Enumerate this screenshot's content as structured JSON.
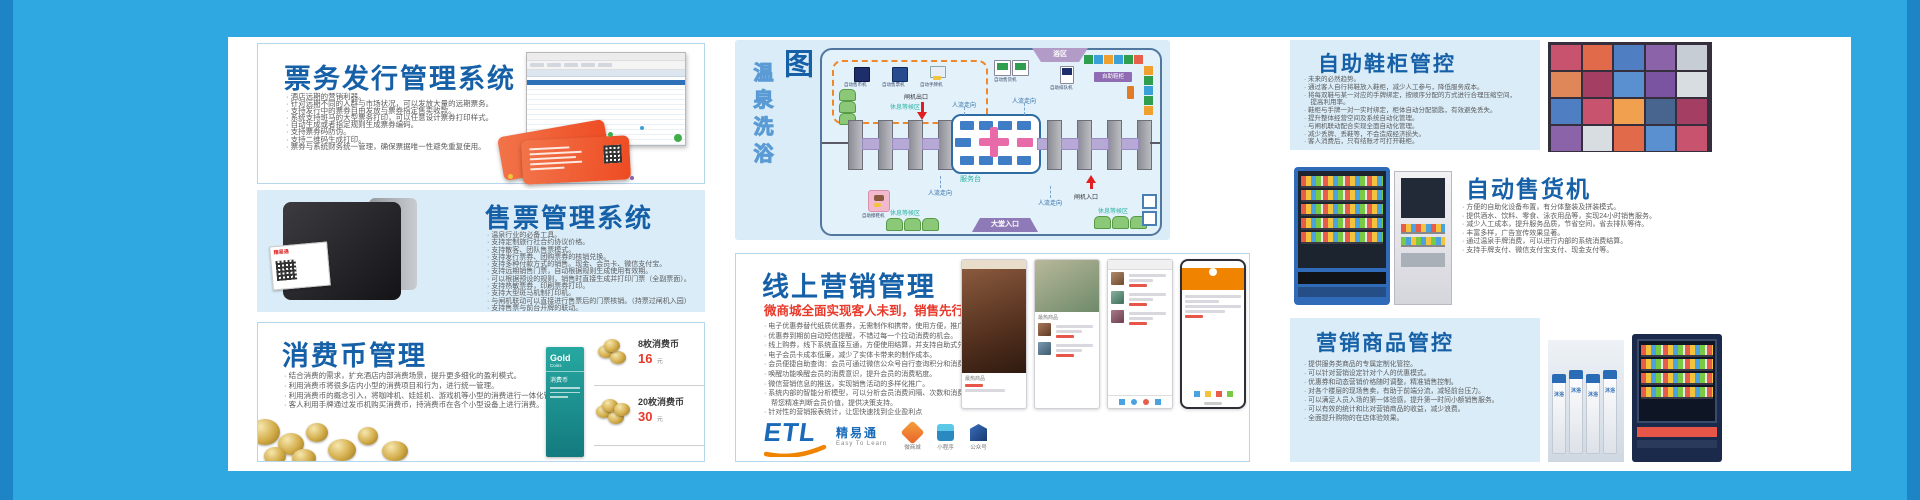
{
  "frame": {
    "outer_blue": "#2fa7e0",
    "edge_blue": "#1d84c5",
    "content_bg": "#ffffff",
    "panel_blue": "#d9ecf8",
    "title_blue": "#1660a8",
    "accent_red": "#e8392a",
    "teal": "#2bb3a3"
  },
  "panels": {
    "ticket_issue": {
      "title": "票务发行管理系统",
      "bullets": [
        "· 酒店远期的营销利器。",
        "· 针对远期不同的人群与市场状况，可以发放大量的远期票务。",
        "· 支持发行中的票券自由发放与票券指定售卖收款。",
        "· 系统支持斑马的大型票务打印，可以任意设计票券打印样式。",
        "· 自动生成或者指定规则生成票券编码。",
        "· 支持票券码防伪。",
        "· 支持二维码生成打印。",
        "· 票券与系统财务统一管理，确保票据唯一性避免重复使用。"
      ]
    },
    "ticket_sale": {
      "title": "售票管理系统",
      "bullets": [
        "· 温泉行业的必备工具。",
        "· 支持定制旅行社合约协议价格。",
        "· 支持散客、团队售票模式。",
        "· 支持发行票券、团购票券的核销兑换。",
        "· 支持多种付款方式的销售。现金、会员卡、微信支付宝。",
        "· 支持远期销售门票，自动根据规则生成使用有效期。",
        "· 可以根据预设的规则，销售时直接生成并打印门票（全副票面）。",
        "· 支持热敏票券，印刷票券打印。",
        "· 支持大型斑马机制打印机。",
        "· 与闸机联动可以直接进行售票后的门票核销。（持票过闸机入园）",
        "· 支持售票与前台开牌的联动。"
      ],
      "printer_brand": "精易通"
    },
    "coin": {
      "title": "消费币管理",
      "bullets": [
        "· 结合消费的需求，扩充酒店内部消费场景，提升更多细化的盈利模式。",
        "· 利用消费币将很多店内小型的消费项目和行为，进行统一管理。",
        "· 利用消费币的概念引入，将咖啡机、娃娃机、游戏机等小型的消费进行一体化管理结算。",
        "· 客人利用手牌通过发币机购买消费币，持消费币在各个小型设备上进行消费。"
      ],
      "card": {
        "brand": "Gold",
        "brand2": "Coins",
        "sub": "消费币"
      },
      "prices": [
        {
          "name": "8枚消费币",
          "price": "16",
          "unit": "元"
        },
        {
          "name": "20枚消费币",
          "price": "30",
          "unit": "元"
        }
      ]
    },
    "flow": {
      "title_main": "自助化流程图",
      "title_sub": "温泉洗浴",
      "labels": {
        "coin_machine": "自动售币机",
        "ticket_machine": "自动售票机",
        "band_machine": "自动手牌机",
        "rest_area": "休息等候区",
        "vending": "自动售货机",
        "bath": "浴区",
        "queue": "自助排队机",
        "shoe_locker": "自助鞋柜",
        "gate_exit": "闸机出口",
        "gate_entry": "闸机入口",
        "service_desk": "服务台",
        "lobby": "大堂入口",
        "shoe_shine": "自助擦鞋机",
        "flow_dir": "人流走向"
      },
      "locker_row": [
        "#2f9e4f",
        "#3aa0d8",
        "#f0a02f",
        "#3aa0d8",
        "#2f9e4f",
        "#e8604a"
      ],
      "locker_col": [
        "#f0a02f",
        "#2f9e4f",
        "#3aa0d8",
        "#2f9e4f",
        "#f0a02f"
      ]
    },
    "marketing": {
      "title": "线上营销管理",
      "subtitle": "微商城全面实现客人未到，销售先行的理念",
      "bullets": [
        "· 电子优惠券替代纸质优惠券，无需制作和携带，使用方便，推广迅速",
        "· 优惠券到期前自动短信提醒，不错过每一个拉动消费的机会。",
        "· 线上购券，线下系统直接互通，方便使用结算，并支持自助式兑换。",
        "· 电子会员卡成本低廉，减少了实体卡带来的制作成本。",
        "· 会员便捷自助查询：会员可通过微信公众号自行查询积分和消费记录。",
        "· 唤醒功能唤醒会员的消费意识，提升会员的消费粘度。",
        "· 微信营销信息的推送，实现销售活动的多样化推广。",
        "· 系统内部的智能分析模型，可以分析会员消费间隔、次数和消费习惯，",
        "　帮您精准判断会员价值，提供决策支持。",
        "· 针对性的营销报表统计，让您快速找到企业盈利点"
      ],
      "hot_label": "最热商品",
      "logo": {
        "etl": "ETL",
        "name": "精易通",
        "tagline": "Easy To Learn"
      },
      "apps": [
        {
          "label": "微商城"
        },
        {
          "label": "小程序"
        },
        {
          "label": "公众号"
        }
      ]
    },
    "shoe_locker": {
      "title": "自助鞋柜管控",
      "bullets": [
        "· 未来的必然趋势。",
        "· 通过客人自行将鞋放入鞋柜，减少人工参与，降低服务成本。",
        "· 将每双鞋与某一对应的手牌绑定，按顺序分配的方式进行合理压缩空间，",
        "　提高利用率。",
        "· 鞋柜与手牌一对一实时绑定，柜体自动分配锁匙，有效避免丢失。",
        "· 提升整体经营空间及系统自动化管理。",
        "· 与闸机联动配合实现全面自动化管理。",
        "· 减少丢牌、丢鞋等，不会造成经济损失。",
        "· 客人消费后，只有结账才可打开鞋柜。"
      ],
      "mosaic": [
        "#c8536e",
        "#e06a4a",
        "#4f7ec2",
        "#8a63a8",
        "#c7cdd5",
        "#e0875a",
        "#a43f63",
        "#5a8fd0",
        "#7a54a0",
        "#d8dde2",
        "#4f7ec2",
        "#c8536e",
        "#f0a04f",
        "#48658f",
        "#a43f63",
        "#8a63a8",
        "#d8dde2",
        "#e06a4a",
        "#5a8fd0",
        "#c8536e"
      ]
    },
    "vending": {
      "title": "自动售货机",
      "bullets": [
        "· 方便的自助化设备布置，有分体整装及拼装模式。",
        "· 提供酒水、饮料、零食、泳衣用品等，实现24小时销售服务。",
        "· 减少人工成本，提升服务品质，节省空间，省去排队等待。",
        "· 丰富多样，广告宣传效果显著。",
        "· 通过温泉手牌消费，可以进行内部的系统消费结算。",
        "· 支持手牌支付、微信支付宝支付、现金支付等。"
      ]
    },
    "goods": {
      "title": "营销商品管控",
      "bullets": [
        "· 提供服务类商品的专属定制化管控。",
        "· 可以针对营销设定针对个人的优惠模式。",
        "· 优惠券和动态营销价格随时调整，精准销售控制。",
        "· 对各个楼层的现场售卖，有助于前端分流，减轻前台压力。",
        "· 可以满足人员入场的第一体验感，提升第一时间小额销售服务。",
        "· 可以有效的统计和比对营销商品的收益，减少浪费。",
        "· 全面提升购物的在店体验效果。"
      ],
      "bottle_label": "沐浴"
    }
  }
}
